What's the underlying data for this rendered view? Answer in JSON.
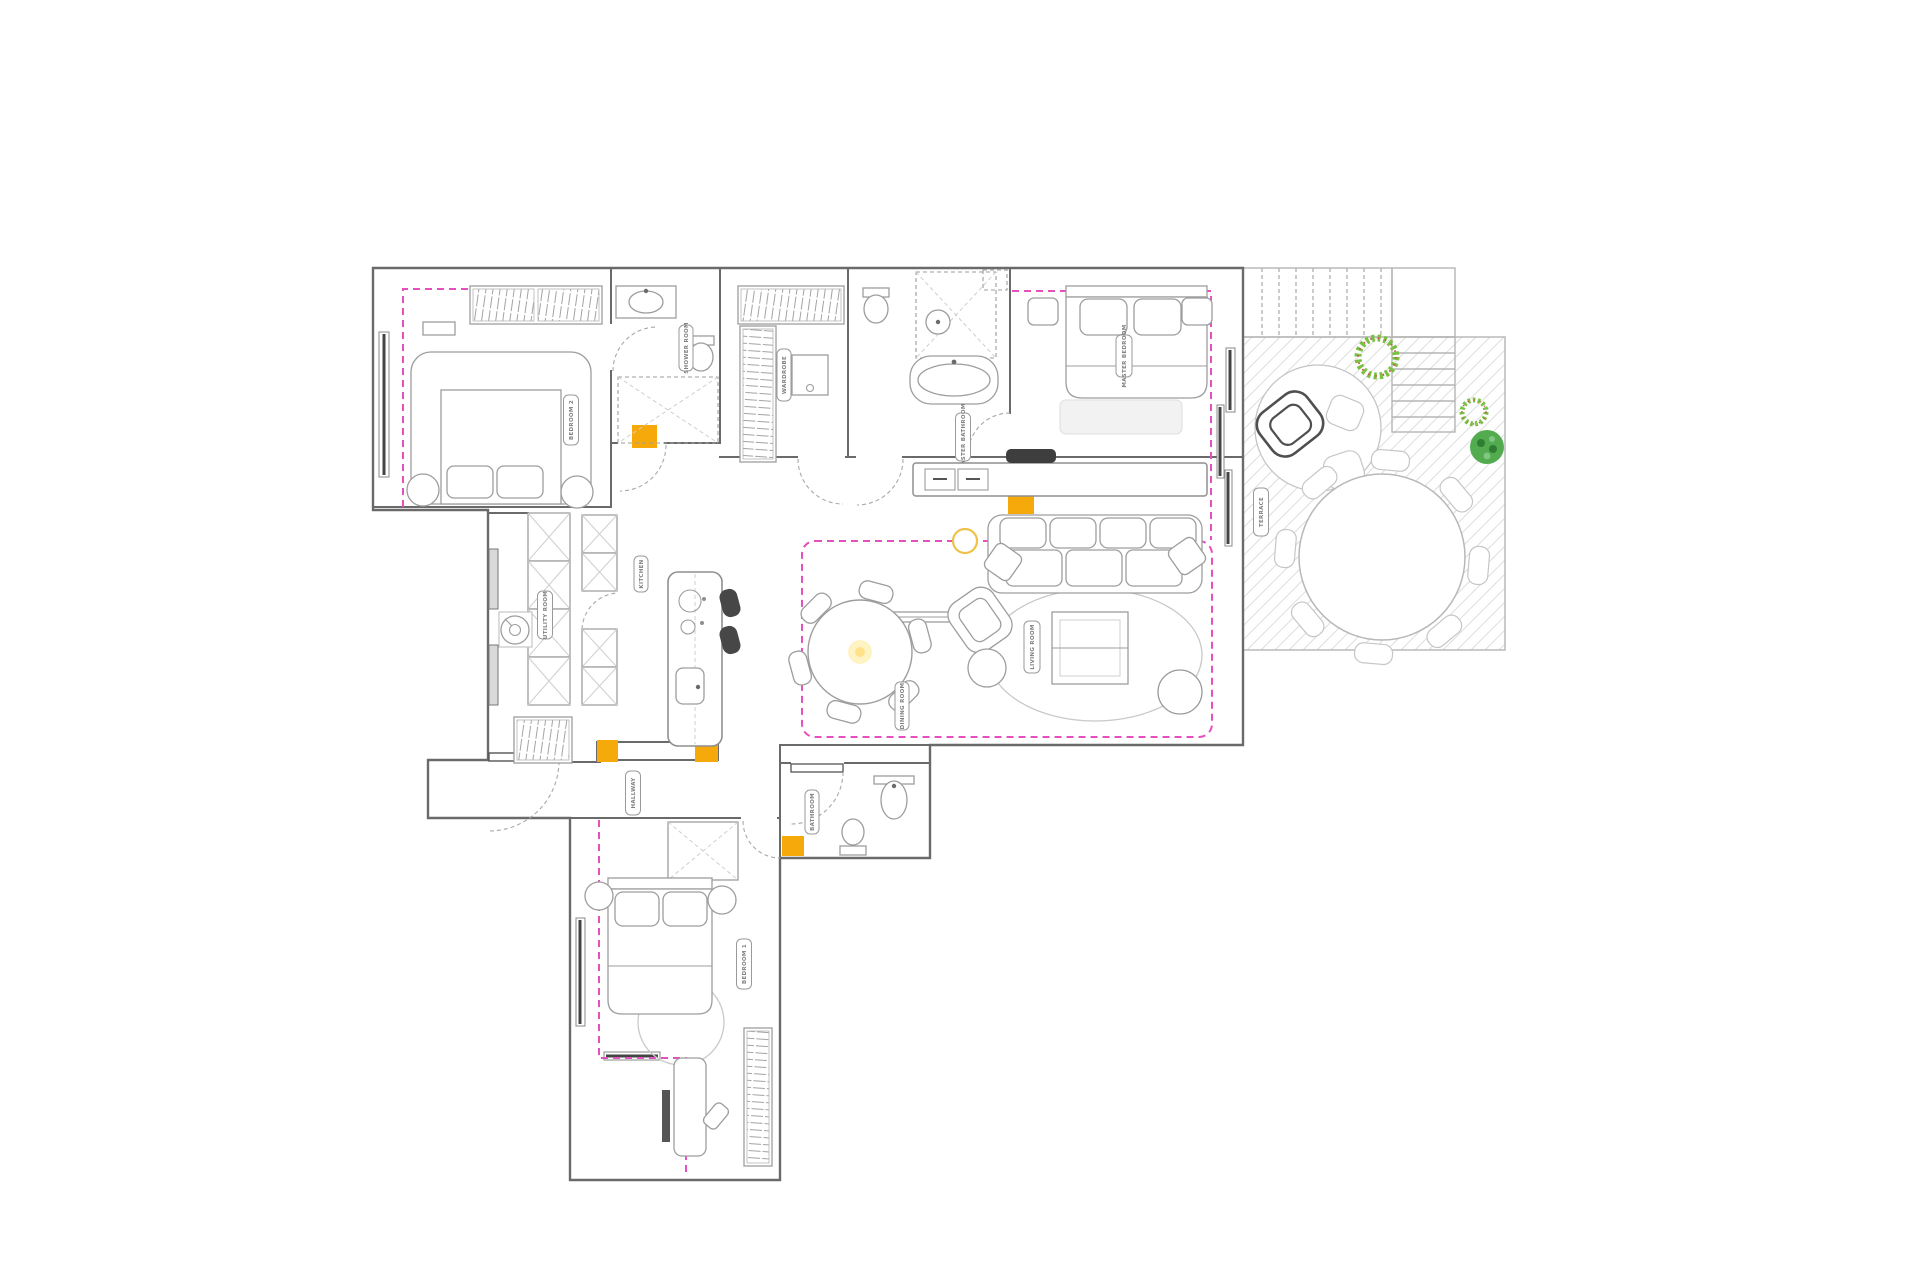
{
  "plan": {
    "rooms": {
      "bedroom2": "BEDROOM 2",
      "ensuite": "SHOWER ROOM",
      "wardrobe": "WARDROBE",
      "master_bathroom": "MASTER BATHROOM",
      "master_bedroom": "MASTER BEDROOM",
      "utility": "UTILITY ROOM",
      "kitchen": "KITCHEN",
      "dining": "DINING ROOM",
      "living": "LIVING ROOM",
      "hallway": "HALLWAY",
      "bathroom": "BATHROOM",
      "bedroom1": "BEDROOM 1",
      "terrace": "TERRACE"
    },
    "colors": {
      "wall": "#6A6A6A",
      "furniture": "#9D9D9D",
      "zone_marker_magenta": "#E650BE",
      "column_yellow": "#F6A90B",
      "plant_green": "#4CAF50",
      "light_glow_yellow": "#FFE28A"
    }
  }
}
